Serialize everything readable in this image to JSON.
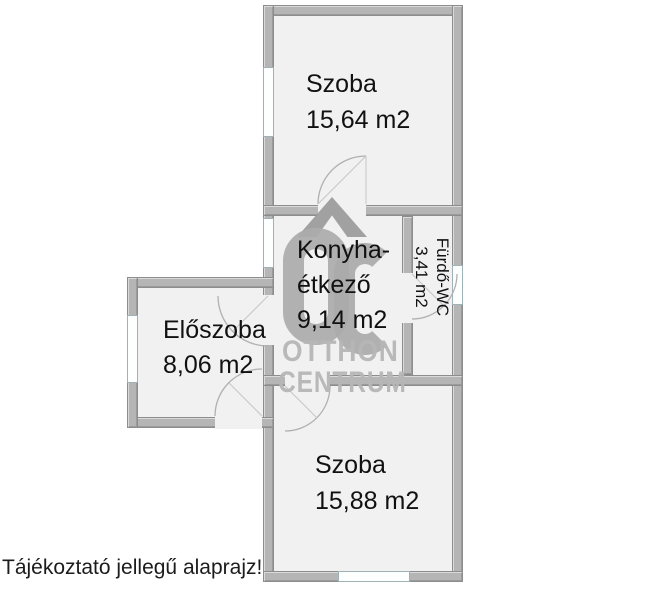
{
  "plan": {
    "rooms": {
      "szoba_top": {
        "name": "Szoba",
        "area": "15,64 m2"
      },
      "konyha": {
        "name_line1": "Konyha-",
        "name_line2": "étkező",
        "area": "9,14 m2"
      },
      "furdo": {
        "name": "Fürdő-WC",
        "area": "3,41 m2"
      },
      "eloszoba": {
        "name": "Előszoba",
        "area": "8,06 m2"
      },
      "szoba_bottom": {
        "name": "Szoba",
        "area": "15,88 m2"
      }
    },
    "disclaimer": "Tájékoztató jellegű alaprajz!"
  },
  "watermark": {
    "monogram": "OC",
    "brand_line1": "OTTHON",
    "brand_line2": "CENTRUM"
  },
  "palette": {
    "wall_fill": "#b5b5b5",
    "wall_edge": "#8d8d8d",
    "floor": "#f1f1f1",
    "window_frame": "#9fb2b6",
    "watermark_gray": "#ababab",
    "label_text": "#111111",
    "background": "#ffffff"
  }
}
